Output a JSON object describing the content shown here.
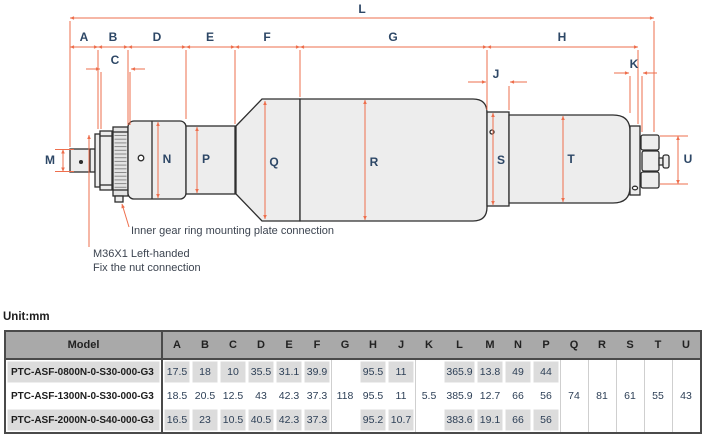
{
  "diagram": {
    "unit_label": "Unit:mm",
    "annotations": {
      "inner_gear": "Inner gear ring mounting plate connection",
      "m36_line1": "M36X1 Left-handed",
      "m36_line2": "Fix the nut connection"
    },
    "dim_labels": {
      "L": "L",
      "A": "A",
      "B": "B",
      "C": "C",
      "D": "D",
      "E": "E",
      "F": "F",
      "G": "G",
      "H": "H",
      "J": "J",
      "K": "K",
      "M": "M",
      "N": "N",
      "P": "P",
      "Q": "Q",
      "R": "R",
      "S": "S",
      "T": "T",
      "U": "U"
    }
  },
  "colors": {
    "dimension_line": "#ee6f4d",
    "dim_label_text": "#2d4766",
    "body_fill": "#ededed",
    "outline": "#2e2e2e",
    "table_header_bg": "#a9a9a9",
    "table_shaded_cell": "#dcdcdc",
    "table_border": "#4a4a4a"
  },
  "table": {
    "columns": [
      "Model",
      "A",
      "B",
      "C",
      "D",
      "E",
      "F",
      "G",
      "H",
      "J",
      "K",
      "L",
      "M",
      "N",
      "P",
      "Q",
      "R",
      "S",
      "T",
      "U"
    ],
    "merged_values": {
      "G": "118",
      "K": "5.5",
      "Q": "74",
      "R": "81",
      "S": "61",
      "T": "55",
      "U": "43"
    },
    "rows": [
      {
        "model": "PTC-ASF-0800N-0-S30-000-G3",
        "A": "17.5",
        "B": "18",
        "C": "10",
        "D": "35.5",
        "E": "31.1",
        "F": "39.9",
        "H": "95.5",
        "J": "11",
        "L": "365.9",
        "M": "13.8",
        "N": "49",
        "P": "44"
      },
      {
        "model": "PTC-ASF-1300N-0-S30-000-G3",
        "A": "18.5",
        "B": "20.5",
        "C": "12.5",
        "D": "43",
        "E": "42.3",
        "F": "37.3",
        "H": "95.5",
        "J": "11",
        "L": "385.9",
        "M": "12.7",
        "N": "66",
        "P": "56"
      },
      {
        "model": "PTC-ASF-2000N-0-S40-000-G3",
        "A": "16.5",
        "B": "23",
        "C": "10.5",
        "D": "40.5",
        "E": "42.3",
        "F": "37.3",
        "H": "95.2",
        "J": "10.7",
        "L": "383.6",
        "M": "19.1",
        "N": "66",
        "P": "56"
      }
    ]
  }
}
